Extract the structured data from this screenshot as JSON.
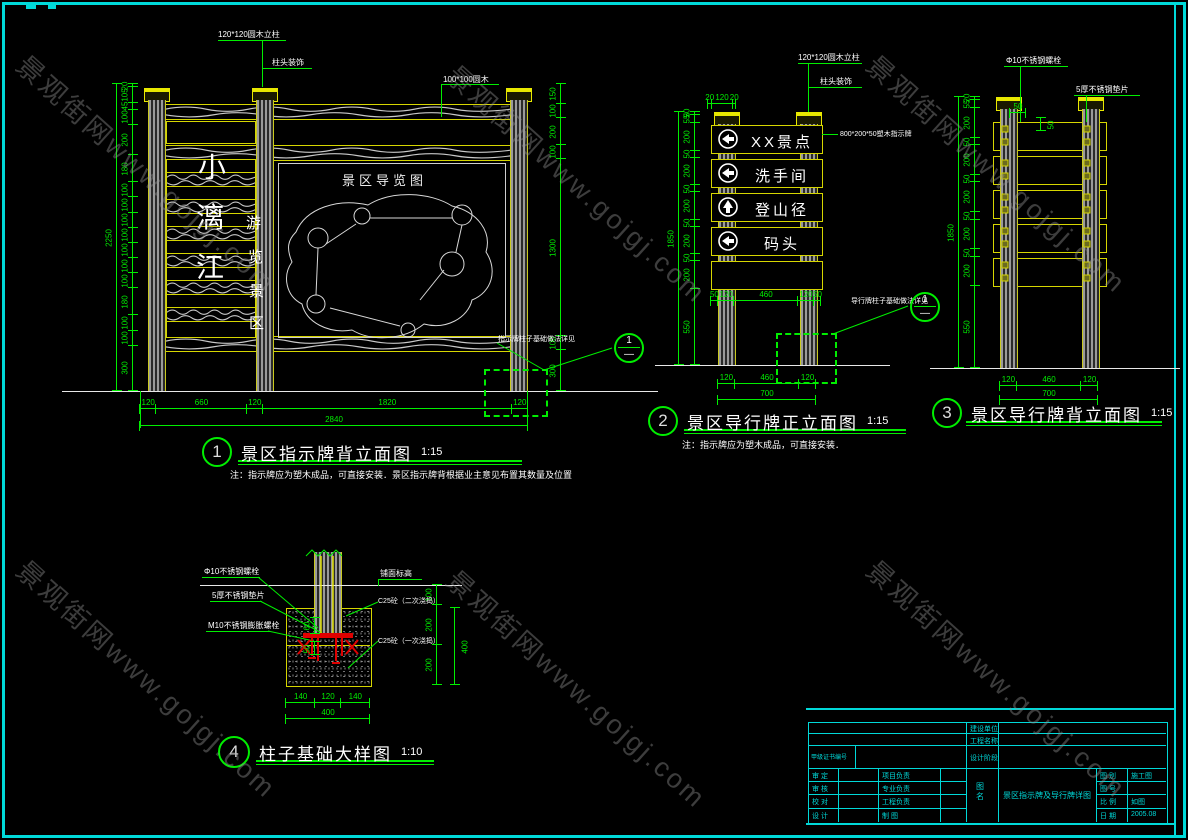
{
  "watermark": {
    "text": "景观街网www.gojgj.com"
  },
  "d1": {
    "num": "1",
    "title": "景区指示牌背立面图",
    "scale": "1:15",
    "note": "注：指示牌应为塑木成品，可直接安装．景区指示牌背根据业主意见布置其数量及位置",
    "label_post": "120*120圆木立柱",
    "label_cap": "柱头装饰",
    "label_rail": "100*100圆木",
    "callout": "指示牌柱子基础做法详见",
    "bubble_num": "1",
    "bubble_ref": "—",
    "big_text": [
      "小",
      "漓",
      "江"
    ],
    "small_text": [
      "游",
      "览",
      "景",
      "区"
    ],
    "map_title": "景区导览图",
    "dims_bottom": [
      "120",
      "660",
      "120",
      "1820",
      "120"
    ],
    "dim_total": "2840",
    "dim_height": "2250",
    "left_chain": [
      "20",
      "105",
      "45",
      "100",
      "200",
      "180",
      "100",
      "100",
      "100",
      "100",
      "100",
      "100",
      "100",
      "180",
      "100",
      "100",
      "300"
    ],
    "right_chain": [
      "150",
      "100",
      "200",
      "100",
      "1300",
      "100",
      "300"
    ]
  },
  "d2": {
    "num": "2",
    "title": "景区导行牌正立面图",
    "scale": "1:15",
    "note": "注：指示牌应为塑木成品，可直接安装．",
    "label_post": "120*120圆木立柱",
    "label_cap": "柱头装饰",
    "label_board": "800*200*50塑木指示牌",
    "callout": "导行牌柱子基础做法详见",
    "bubble_num": "1",
    "bubble_ref": "—",
    "panels": [
      "XX景点",
      "洗手间",
      "登山径",
      "码头"
    ],
    "dims_top": [
      "20",
      "120",
      "20"
    ],
    "dims_mid": [
      "50",
      "120",
      "460",
      "120",
      "50"
    ],
    "dims_bottom": [
      "120",
      "460",
      "120"
    ],
    "dim_total": "700",
    "dim_height": "1850",
    "left_chain": [
      "20",
      "5",
      "55",
      "200",
      "50",
      "200",
      "50",
      "200",
      "50",
      "200",
      "50",
      "200",
      "550"
    ]
  },
  "d3": {
    "num": "3",
    "title": "景区导行牌背立面图",
    "scale": "1:15",
    "label_bolt": "Φ10不锈钢螺栓",
    "label_plate": "5厚不锈钢垫片",
    "dim_a": "50",
    "dim_b": "50",
    "dims_bottom": [
      "120",
      "460",
      "120"
    ],
    "dim_total": "700",
    "dim_height": "1850",
    "left_chain": [
      "20",
      "55",
      "200",
      "50",
      "200",
      "50",
      "200",
      "50",
      "200",
      "50",
      "200",
      "550"
    ]
  },
  "d4": {
    "num": "4",
    "title": "柱子基础大样图",
    "scale": "1:10",
    "label_bolt": "Φ10不锈钢螺栓",
    "label_plate": "5厚不锈钢垫片",
    "label_anchor": "M10不锈钢膨胀螺栓",
    "label_level": "铺面标高",
    "label_c25_top": "C25砼（二次浇捣）",
    "label_c25_bottom": "C25砼（一次浇捣）",
    "dim_60": "60",
    "dim_50": "50",
    "right_chain": [
      "100",
      "200",
      "200"
    ],
    "dim_400": "400",
    "dims_bottom": [
      "140",
      "120",
      "140"
    ],
    "dim_total": "400"
  },
  "tb": {
    "f1": "建设单位",
    "f2": "工程名称",
    "f3": "设计阶段",
    "cert": "甲级证书编号",
    "rows_left": [
      "审 定",
      "审 核",
      "校 对",
      "设 计"
    ],
    "rows_mid": [
      "项目负责",
      "专业负责",
      "工程负责",
      "制  图"
    ],
    "sheet_label": "图名",
    "sheet_name": "景区指示牌及导行牌详图",
    "r1_label": "图 别",
    "r1_val": "施工图",
    "r2_label": "图 号",
    "r2_val": "",
    "r3_label": "比 例",
    "r3_val": "如图",
    "r4_label": "日 期",
    "r4_val": "2005.08"
  }
}
